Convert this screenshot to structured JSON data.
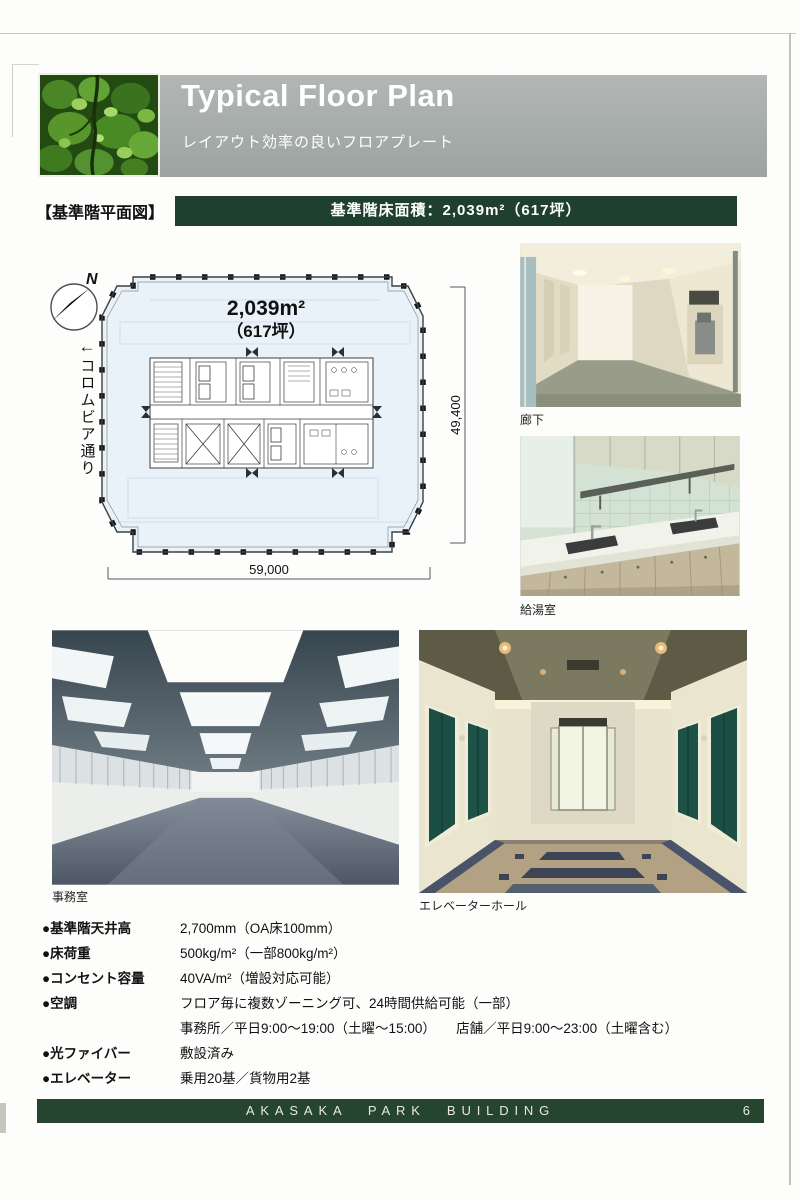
{
  "header": {
    "title": "Typical Floor Plan",
    "subtitle": "レイアウト効率の良いフロアプレート"
  },
  "section": {
    "label": "【基準階平面図】",
    "area_banner": "基準階床面積：2,039m²（617坪）"
  },
  "plan": {
    "north": "N",
    "street_arrow": "←",
    "street": "コロムビア通り",
    "area_m2": "2,039m²",
    "area_tsubo": "（617坪）",
    "dim_height": "49,400",
    "dim_width": "59,000"
  },
  "photos": {
    "corridor": "廊下",
    "kitchenette": "給湯室",
    "office": "事務室",
    "elevator_hall": "エレベーターホール"
  },
  "specs": [
    {
      "label": "●基準階天井高",
      "value": "2,700mm（OA床100mm）"
    },
    {
      "label": "●床荷重",
      "value": "500kg/m²（一部800kg/m²）"
    },
    {
      "label": "●コンセント容量",
      "value": "40VA/m²（増設対応可能）"
    },
    {
      "label": "●空調",
      "value": "フロア毎に複数ゾーニング可、24時間供給可能（一部）"
    },
    {
      "label": "",
      "value": "事務所／平日9:00～19:00（土曜～15:00）　　店舗／平日9:00～23:00（土曜含む）"
    },
    {
      "label": "●光ファイバー",
      "value": "敷設済み"
    },
    {
      "label": "●エレベーター",
      "value": "乗用20基／貨物用2基"
    }
  ],
  "footer": {
    "name": "AKASAKA PARK BUILDING",
    "page": "6"
  },
  "colors": {
    "brand_green": "#20402f",
    "banner_gray": "#a8aeac",
    "plan_fill": "#e9f2f9"
  }
}
